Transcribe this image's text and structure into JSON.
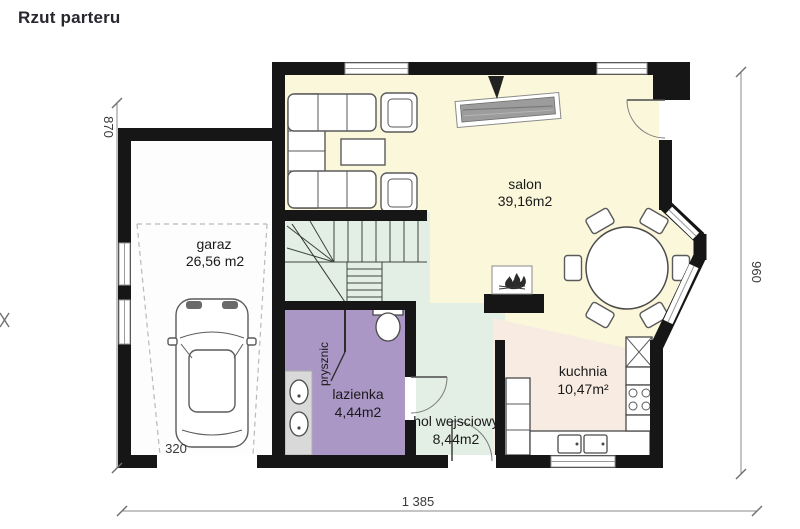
{
  "title": "Rzut parteru",
  "plan": {
    "rooms": {
      "garage": {
        "label": "garaz",
        "area": "26,56 m2"
      },
      "living_room": {
        "label": "salon",
        "area": "39,16m2"
      },
      "kitchen": {
        "label": "kuchnia",
        "area": "10,47m²"
      },
      "bathroom": {
        "label": "lazienka",
        "area": "4,44m2"
      },
      "entry_hall": {
        "label": "hol wejsciowy",
        "area": "8,44m2"
      },
      "shower": {
        "label": "prysznic"
      }
    },
    "dimensions": {
      "bottom_width": "1 385",
      "left_height": "870",
      "right_height": "960",
      "garage_door": "320"
    },
    "colors": {
      "wall": "#161616",
      "living_room": "#faf7da",
      "kitchen": "#f8ece2",
      "hall": "#e3efe5",
      "stairs": "#e3efe5",
      "bathroom": "#ab97c5",
      "garage": "#fdfdfd",
      "counter": "#d9d9d9"
    }
  }
}
